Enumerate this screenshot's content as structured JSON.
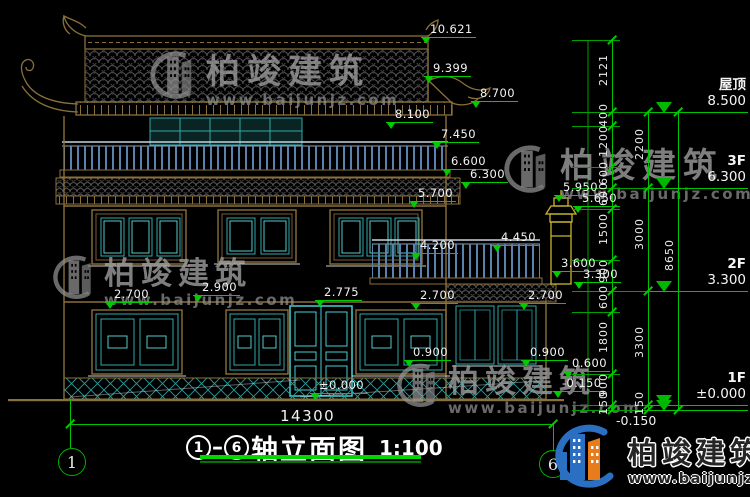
{
  "drawing": {
    "type": "architectural elevation (CAD)",
    "background": "#000000"
  },
  "title_block": {
    "title": "轴立面图",
    "scale": "1:100"
  },
  "axes": {
    "left": "1",
    "right": "6"
  },
  "bottom_dimension": {
    "total": "14300"
  },
  "watermark": {
    "name": "柏竣建筑",
    "url": "www.baijunjz.com"
  },
  "brand": {
    "name": "柏竣建筑",
    "url": "www.baijunjz.com"
  },
  "colors": {
    "dim_green": "#00cc00",
    "wall_tan": "#8a703a",
    "window_teal": "#2fa8a8",
    "door_cyan": "#45d0d0",
    "rail_blue": "#5b82ad",
    "chimney_yellow": "#c9b62b",
    "brand_blue": "#2b6fc2",
    "brand_orange": "#e87b1a"
  },
  "elevation_markers": [
    {
      "v": "10.621",
      "x": 421,
      "y": 23
    },
    {
      "v": "9.399",
      "x": 424,
      "y": 62
    },
    {
      "v": "8.700",
      "x": 471,
      "y": 87
    },
    {
      "v": "8.100",
      "x": 386,
      "y": 108
    },
    {
      "v": "7.450",
      "x": 432,
      "y": 128
    },
    {
      "v": "6.600",
      "x": 442,
      "y": 155
    },
    {
      "v": "6.300",
      "x": 461,
      "y": 168
    },
    {
      "v": "5.700",
      "x": 409,
      "y": 187
    },
    {
      "v": "5.950",
      "x": 554,
      "y": 181
    },
    {
      "v": "5.650",
      "x": 573,
      "y": 192
    },
    {
      "v": "4.450",
      "x": 492,
      "y": 231
    },
    {
      "v": "4.200",
      "x": 411,
      "y": 239
    },
    {
      "v": "3.600",
      "x": 552,
      "y": 257
    },
    {
      "v": "3.300",
      "x": 574,
      "y": 268
    },
    {
      "v": "2.900",
      "x": 193,
      "y": 281
    },
    {
      "v": "2.775",
      "x": 315,
      "y": 286
    },
    {
      "v": "2.700",
      "x": 105,
      "y": 288
    },
    {
      "v": "2.700",
      "x": 411,
      "y": 289
    },
    {
      "v": "2.700",
      "x": 519,
      "y": 289
    },
    {
      "v": "0.900",
      "x": 404,
      "y": 346
    },
    {
      "v": "0.900",
      "x": 521,
      "y": 346
    },
    {
      "v": "0.600",
      "x": 563,
      "y": 357
    },
    {
      "v": "±0.000",
      "x": 310,
      "y": 379
    },
    {
      "v": "-0.150",
      "x": 553,
      "y": 377
    }
  ],
  "right_dimensions": {
    "inner_chain": [
      {
        "v": "2121",
        "y1": 40,
        "y2": 112
      },
      {
        "v": "400",
        "y1": 112,
        "y2": 126
      },
      {
        "v": "1200",
        "y1": 126,
        "y2": 167
      },
      {
        "v": "600",
        "y1": 167,
        "y2": 188
      },
      {
        "v": "600",
        "y1": 188,
        "y2": 209
      },
      {
        "v": "1500",
        "y1": 209,
        "y2": 260
      },
      {
        "v": "900",
        "y1": 260,
        "y2": 291
      },
      {
        "v": "600",
        "y1": 291,
        "y2": 312
      },
      {
        "v": "1800",
        "y1": 312,
        "y2": 374
      },
      {
        "v": "900",
        "y1": 374,
        "y2": 405
      },
      {
        "v": "150",
        "y1": 405,
        "y2": 410
      }
    ],
    "middle_chain": [
      {
        "v": "2200",
        "y1": 112,
        "y2": 188
      },
      {
        "v": "3000",
        "y1": 188,
        "y2": 291
      },
      {
        "v": "3300",
        "y1": 291,
        "y2": 405
      },
      {
        "v": "150",
        "y1": 405,
        "y2": 410
      }
    ],
    "overall_chain": [
      {
        "v": "8650",
        "y1": 112,
        "y2": 410
      }
    ],
    "levels": [
      {
        "label": "屋顶",
        "elev": "8.500",
        "y": 112
      },
      {
        "label": "3F",
        "elev": "6.300",
        "y": 188
      },
      {
        "label": "2F",
        "elev": "3.300",
        "y": 291
      },
      {
        "label": "1F",
        "elev": "±0.000",
        "y": 405
      },
      {
        "label": "",
        "elev": "-0.150",
        "y": 410
      }
    ]
  }
}
